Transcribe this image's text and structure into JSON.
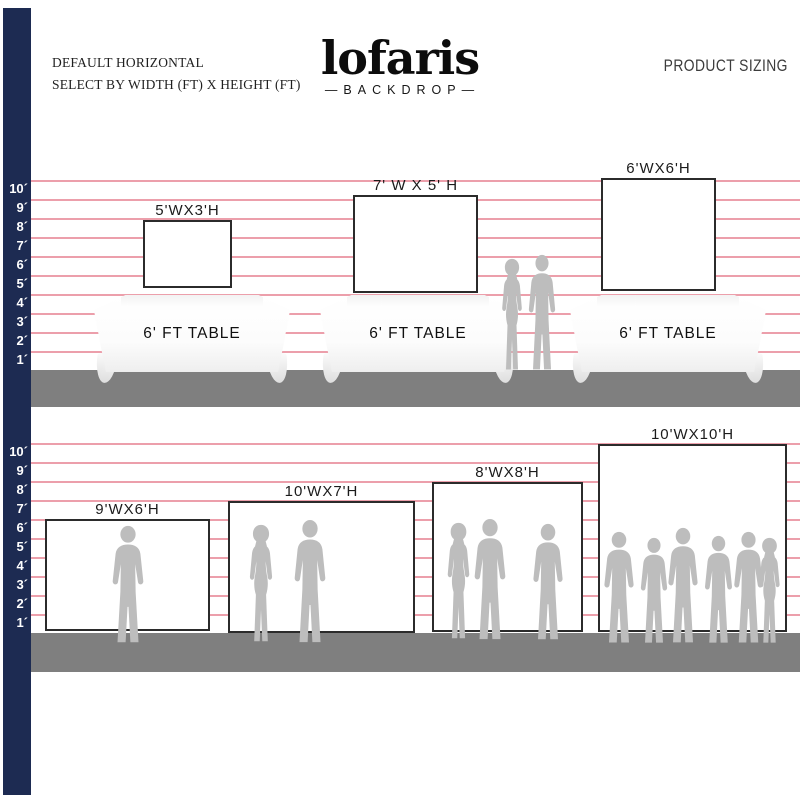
{
  "header": {
    "tagline_line1": "DEFAULT HORIZONTAL",
    "tagline_line2": "SELECT BY WIDTH (FT) X HEIGHT (FT)",
    "brand": "lofaris",
    "brand_sub": "—BACKDROP—",
    "product_sizing": "PRODUCT SIZING"
  },
  "ruler": [
    "10´",
    "9´",
    "8´",
    "7´",
    "6´",
    "5´",
    "4´",
    "3´",
    "2´",
    "1´"
  ],
  "row1": {
    "table_label": "6' FT TABLE",
    "backdrops": [
      {
        "label": "5'WX3'H",
        "width_ft": 5,
        "height_ft": 3
      },
      {
        "label": "7' W X 5' H",
        "width_ft": 7,
        "height_ft": 5
      },
      {
        "label": "6'WX6'H",
        "width_ft": 6,
        "height_ft": 6
      }
    ]
  },
  "row2": {
    "backdrops": [
      {
        "label": "9'WX6'H",
        "width_ft": 9,
        "height_ft": 6
      },
      {
        "label": "10'WX7'H",
        "width_ft": 10,
        "height_ft": 7
      },
      {
        "label": "8'WX8'H",
        "width_ft": 8,
        "height_ft": 8
      },
      {
        "label": "10'WX10'H",
        "width_ft": 10,
        "height_ft": 10
      }
    ]
  },
  "colors": {
    "navy": "#1d2b52",
    "grid_pink": "#ec9fab",
    "ground_gray": "#7f7f7f",
    "silhouette_gray": "#bdbdbd"
  }
}
